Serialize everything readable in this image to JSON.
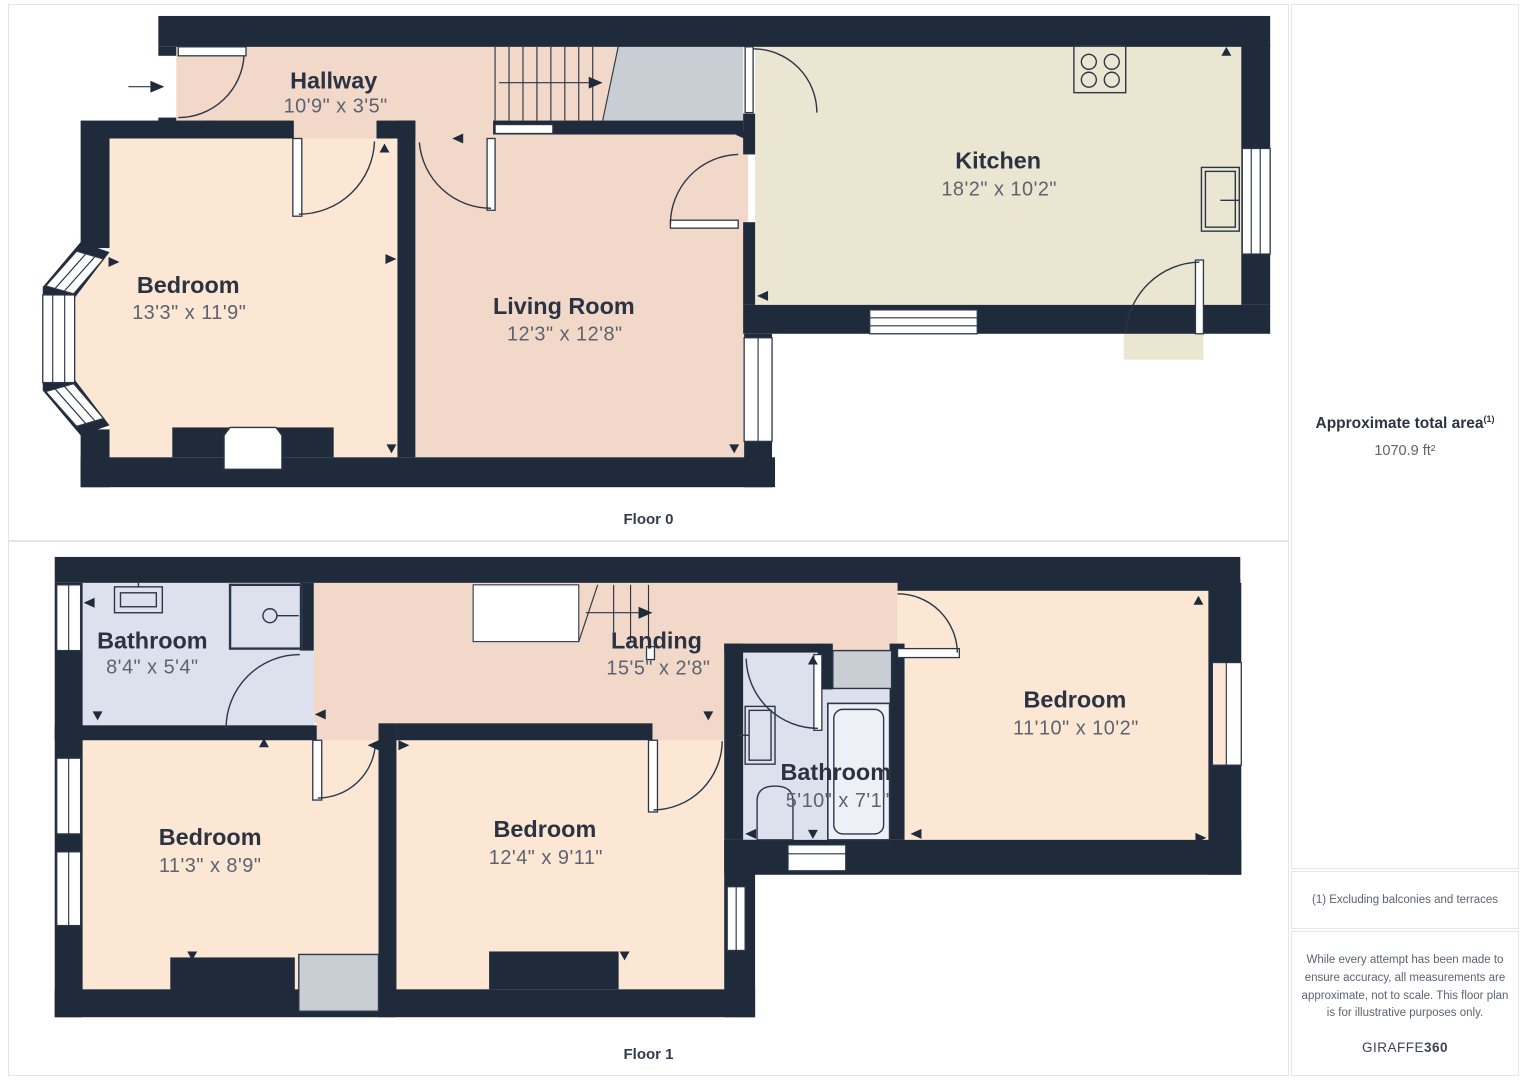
{
  "floors": [
    {
      "id": "floor-0",
      "label": "Floor 0",
      "rooms": [
        {
          "id": "hallway",
          "name": "Hallway",
          "dims": "10'9\" x 3'5\""
        },
        {
          "id": "bedroom",
          "name": "Bedroom",
          "dims": "13'3\" x 11'9\""
        },
        {
          "id": "living-room",
          "name": "Living Room",
          "dims": "12'3\" x 12'8\""
        },
        {
          "id": "kitchen",
          "name": "Kitchen",
          "dims": "18'2\" x 10'2\""
        }
      ]
    },
    {
      "id": "floor-1",
      "label": "Floor 1",
      "rooms": [
        {
          "id": "bathroom-top",
          "name": "Bathroom",
          "dims": "8'4\" x 5'4\""
        },
        {
          "id": "landing",
          "name": "Landing",
          "dims": "15'5\" x 2'8\""
        },
        {
          "id": "bedroom-right",
          "name": "Bedroom",
          "dims": "11'10\" x 10'2\""
        },
        {
          "id": "bathroom-mid",
          "name": "Bathroom",
          "dims": "5'10\" x 7'1\""
        },
        {
          "id": "bedroom-left",
          "name": "Bedroom",
          "dims": "11'3\" x 8'9\""
        },
        {
          "id": "bedroom-middle",
          "name": "Bedroom",
          "dims": "12'4\" x 9'11\""
        }
      ]
    }
  ],
  "sidebar": {
    "area_title": "Approximate total area",
    "area_superscript": "(1)",
    "area_value": "1070.9 ft²",
    "footnote": "(1) Excluding balconies and terraces",
    "disclaimer": "While every attempt has been made to ensure accuracy, all measurements are approximate, not to scale. This floor plan is for illustrative purposes only.",
    "brand": "GIRAFFE",
    "brand_suffix": "360"
  },
  "colors": {
    "wall": "#1f2a3a",
    "salmon": "#f2d8c8",
    "peach": "#fbe7d3",
    "cream": "#ebe6d1",
    "blue": "#dce1ed",
    "gray": "#c9cdd4",
    "line": "#2b3648",
    "ink": "#2b3342",
    "dim": "#5d6370",
    "border": "#e4e6e9"
  }
}
